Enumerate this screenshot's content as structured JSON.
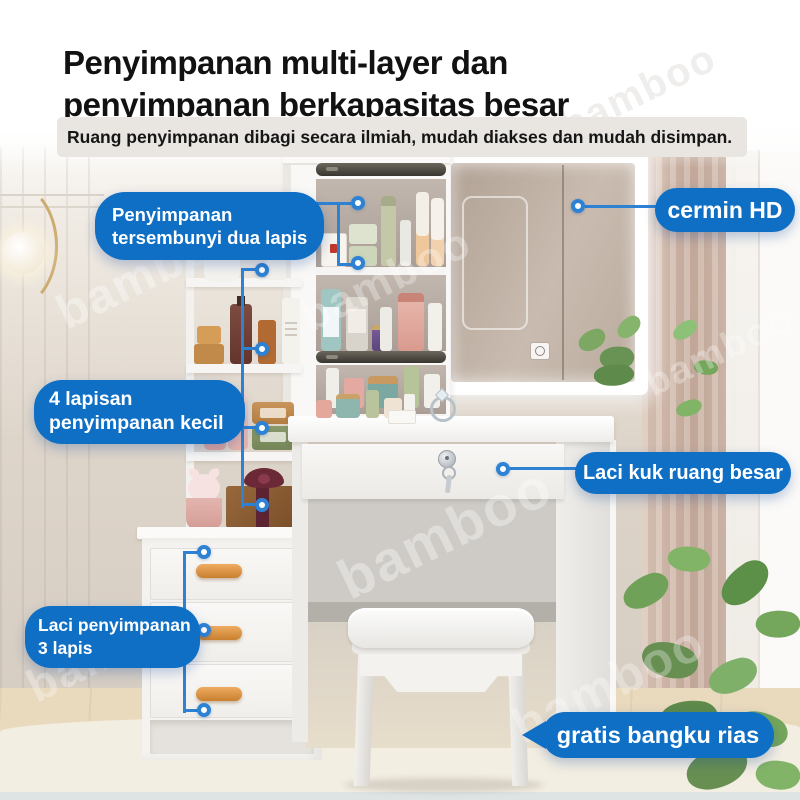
{
  "colors": {
    "badge": "#0f6fc5",
    "line": "#2e82d4",
    "wood": "#d8913f"
  },
  "header": {
    "title_line1": "Penyimpanan multi-layer dan",
    "title_line2": "penyimpanan berkapasitas besar",
    "subtitle": "Ruang penyimpanan dibagi secara ilmiah, mudah diakses dan mudah disimpan."
  },
  "callouts": {
    "hidden_two_layer": {
      "label": "Penyimpanan\ntersembunyi dua lapis"
    },
    "hd_mirror": {
      "label": "cermin HD"
    },
    "four_small_layers": {
      "label": "4 lapisan\npenyimpanan kecil"
    },
    "big_drawer": {
      "label": "Laci kuk ruang besar"
    },
    "three_layer_drawers": {
      "label": "Laci penyimpanan\n3 lapis"
    },
    "free_stool": {
      "label": "gratis bangku rias"
    }
  },
  "watermark": {
    "text": "bamboo"
  }
}
